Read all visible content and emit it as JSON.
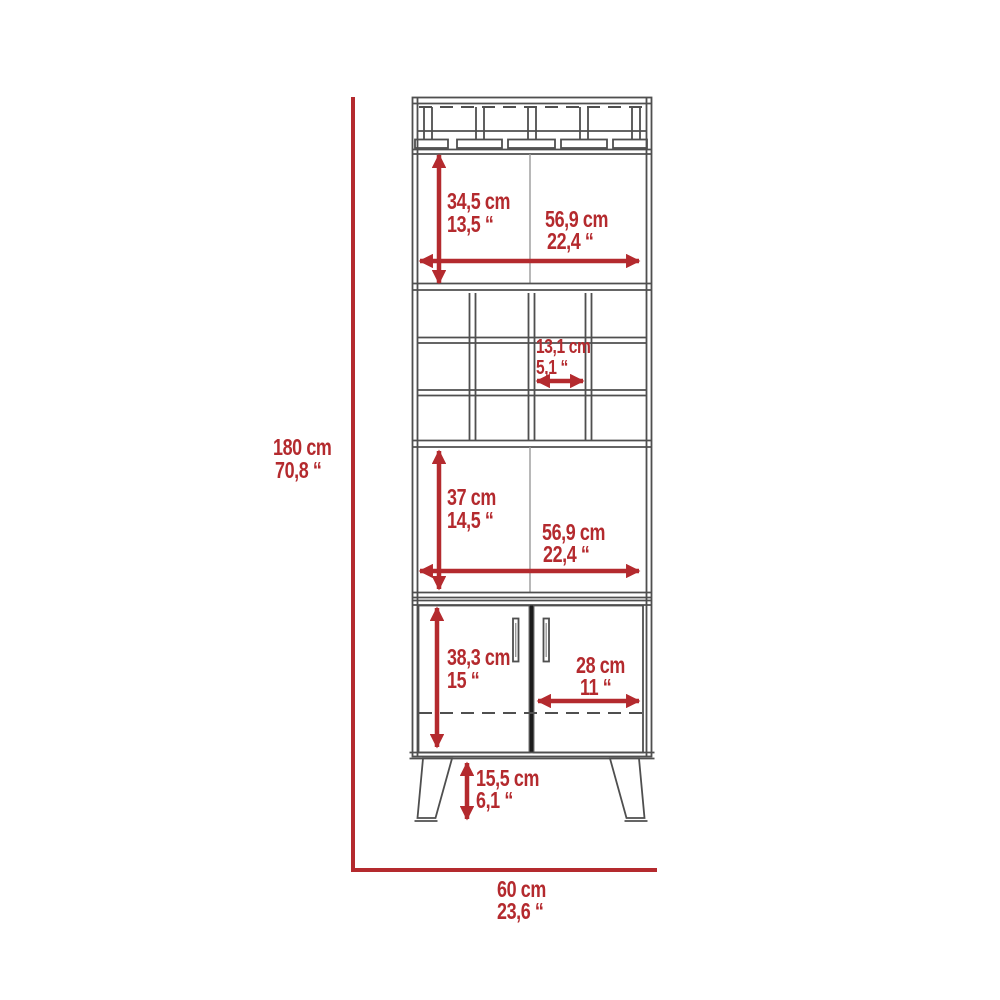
{
  "title": "Bar cabinet dimension diagram",
  "colors": {
    "accent": "#b42a2e",
    "line": "#4f4f4f"
  },
  "overall": {
    "height_cm": "180 cm",
    "height_in": "70,8 “",
    "width_cm": "60 cm",
    "width_in": "23,6 “"
  },
  "top_shelf": {
    "height_cm": "34,5 cm",
    "height_in": "13,5 “",
    "width_cm": "56,9 cm",
    "width_in": "22,4 “"
  },
  "wine_cubby": {
    "width_cm": "13,1 cm",
    "width_in": "5,1 “"
  },
  "mid_shelf": {
    "height_cm": "37 cm",
    "height_in": "14,5 “",
    "width_cm": "56,9 cm",
    "width_in": "22,4 “"
  },
  "lower_cabinet": {
    "height_cm": "38,3 cm",
    "height_in": "15 “",
    "door_width_cm": "28 cm",
    "door_width_in": "11 “"
  },
  "legs": {
    "height_cm": "15,5 cm",
    "height_in": "6,1 “"
  }
}
